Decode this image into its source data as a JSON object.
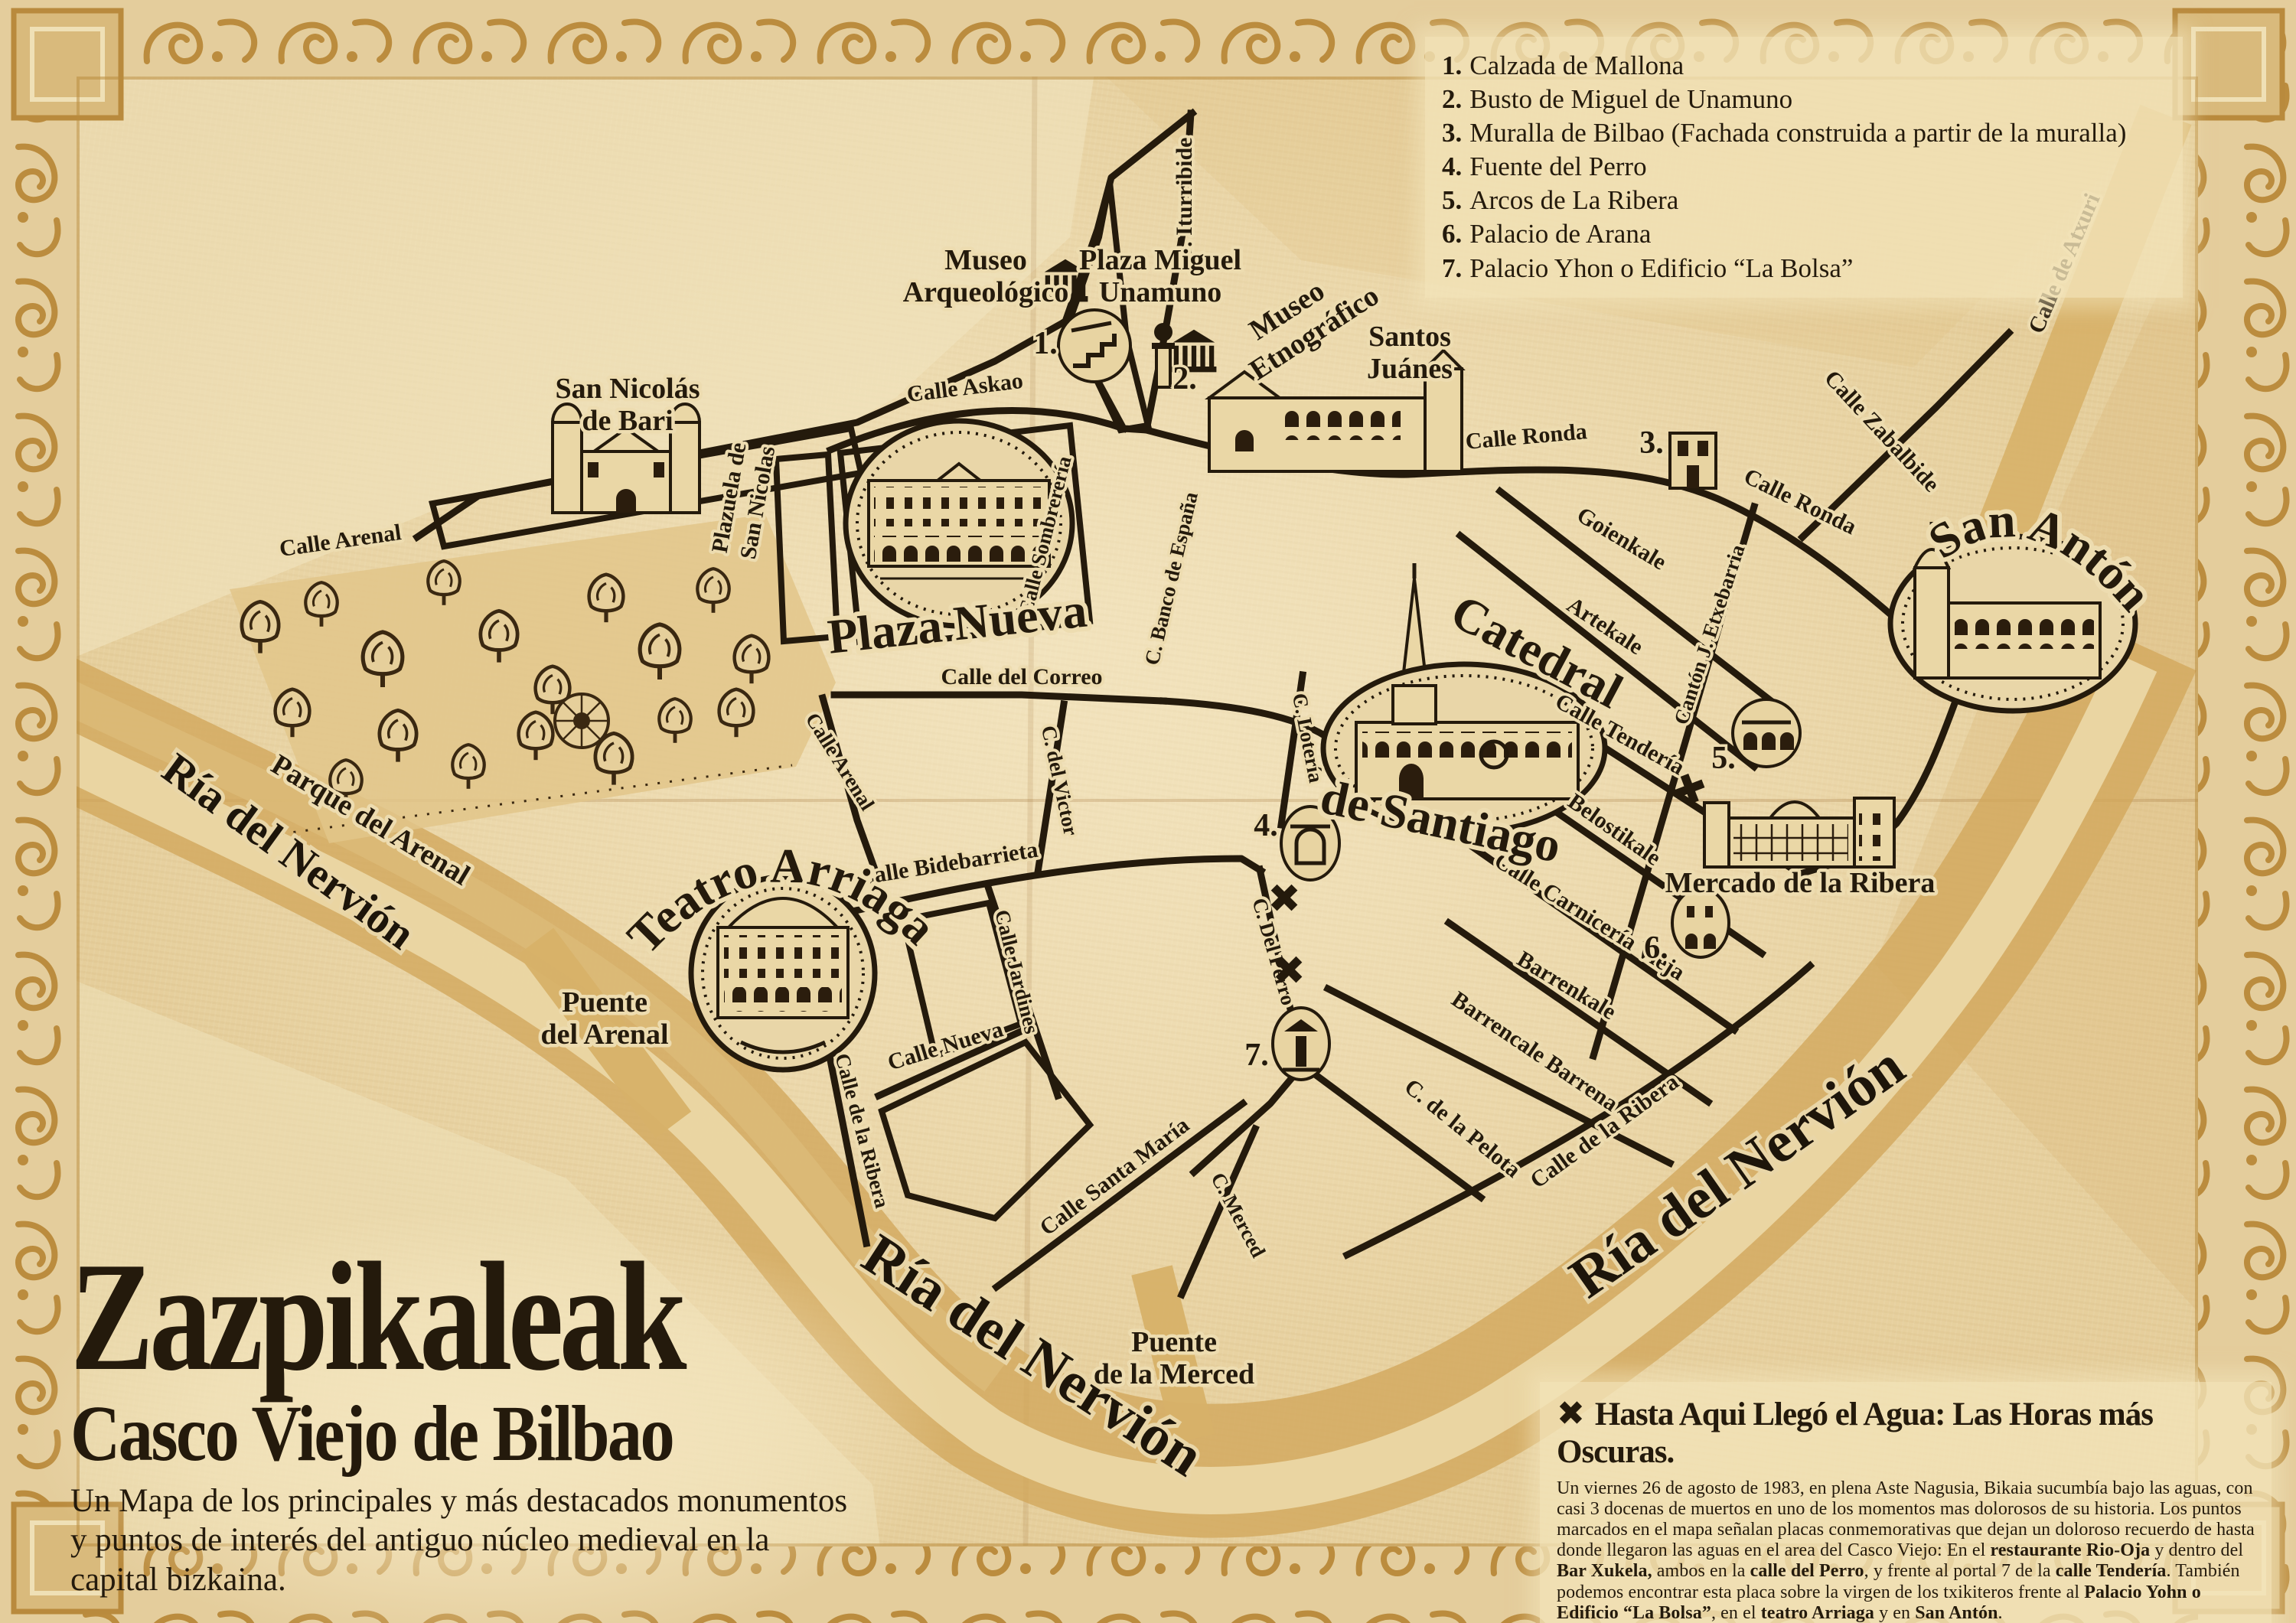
{
  "palette": {
    "parchment": "#e7d2a2",
    "ink": "#241a0c",
    "gold": "#c89a4a",
    "river": "#d2a75d",
    "halo": "#eddcb0"
  },
  "title_block": {
    "title": "Zazpikaleak",
    "subtitle": "Casco Viejo de Bilbao",
    "description": "Un Mapa de los principales y más destacados monumentos y puntos de interés del antiguo núcleo medieval en la capital bizkaina."
  },
  "legend": {
    "items": [
      {
        "num": "1.",
        "label": "Calzada de Mallona"
      },
      {
        "num": "2.",
        "label": "Busto de Miguel de Unamuno"
      },
      {
        "num": "3.",
        "label": "Muralla de Bilbao (Fachada construida a partir de la muralla)"
      },
      {
        "num": "4.",
        "label": "Fuente del Perro"
      },
      {
        "num": "5.",
        "label": "Arcos de La Ribera"
      },
      {
        "num": "6.",
        "label": "Palacio de Arana"
      },
      {
        "num": "7.",
        "label": "Palacio Yhon o Edificio “La Bolsa”"
      }
    ]
  },
  "info_box": {
    "x_icon": "✖",
    "heading": "Hasta Aqui Llegó el Agua: Las Horas más Oscuras.",
    "segments": [
      "Un viernes 26 de agosto de 1983, en plena Aste Nagusia, Bikaia sucumbía bajo las aguas, con casi 3 docenas de muertos en uno de los momentos mas dolorosos de su historia. Los puntos marcados en el mapa señalan placas conmemorativas que dejan un doloroso recuerdo de hasta donde llegaron las aguas en el area del Casco Viejo: En el ",
      "restaurante Rio-Oja",
      " y dentro del ",
      "Bar Xukela,",
      " ambos en la ",
      "calle del Perro",
      ", y frente al portal 7 de la ",
      "calle Tendería",
      ". También podemos encontrar esta placa sobre la virgen de los txikiteros frente al ",
      "Palacio Yohn o Edificio “La Bolsa”",
      ", en el ",
      "teatro Arriaga",
      " y en ",
      "San Antón",
      "."
    ]
  },
  "map": {
    "water_marker_icon": "✖",
    "markers": [
      "1.",
      "2.",
      "3.",
      "4.",
      "5.",
      "6.",
      "7."
    ],
    "streets": [
      {
        "text": "Calle Arenal"
      },
      {
        "text": "Calle Askao"
      },
      {
        "text": "C. Iturribide"
      },
      {
        "text": "Calle Sombrerería"
      },
      {
        "text": "C. Banco de España"
      },
      {
        "text": "Calle del Correo"
      },
      {
        "text": "C. del Victor"
      },
      {
        "text": "Calle Arenal"
      },
      {
        "text": "Calle Bidebarrieta"
      },
      {
        "text": "Calle Jardines"
      },
      {
        "text": "Calle Nueva"
      },
      {
        "text": "Calle de la Ribera"
      },
      {
        "text": "Calle Santa María"
      },
      {
        "text": "C. Merced"
      },
      {
        "text": "C. Del Perro"
      },
      {
        "text": "C. Lotería"
      },
      {
        "text": "C. de la Pelota"
      },
      {
        "text": "Barrencale Barrena"
      },
      {
        "text": "Barrenkale"
      },
      {
        "text": "Calle Carnicería Vieja"
      },
      {
        "text": "Belostikale"
      },
      {
        "text": "Calle Tendería"
      },
      {
        "text": "Cantón J. Etxebarria"
      },
      {
        "text": "Artekale"
      },
      {
        "text": "Goienkale"
      },
      {
        "text": "Calle Ronda"
      },
      {
        "text": "Calle Ronda"
      },
      {
        "text": "Calle Zabalbide"
      },
      {
        "text": "Calle de Atxuri"
      },
      {
        "text": "Calle de la Ribera"
      }
    ],
    "places": {
      "san_nicolas": {
        "line1": "San Nicolás",
        "line2": "de Bari"
      },
      "plazuela": {
        "line1": "Plazuela de",
        "line2": "San Nicolas"
      },
      "museo_arqueologico": {
        "line1": "Museo",
        "line2": "Arqueológico"
      },
      "plaza_unamuno": {
        "line1": "Plaza Miguel",
        "line2": "Unamuno"
      },
      "museo_etnografico": {
        "line1": "Museo",
        "line2": "Etnográfico"
      },
      "santos_juanes": {
        "line1": "Santos",
        "line2": "Juánes"
      },
      "plaza_nueva": "Plaza Nueva",
      "teatro_arriaga": "Teatro Arriaga",
      "catedral_line1": "Catedral",
      "catedral_line2": "de Santiago",
      "san_anton": "San Antón",
      "mercado": "Mercado de la Ribera",
      "parque": "Parque del Arenal",
      "puente_arenal": {
        "line1": "Puente",
        "line2": "del Arenal"
      },
      "puente_merced": {
        "line1": "Puente",
        "line2": "de la Merced"
      },
      "ria_nervion": "Ría del Nervión"
    }
  }
}
